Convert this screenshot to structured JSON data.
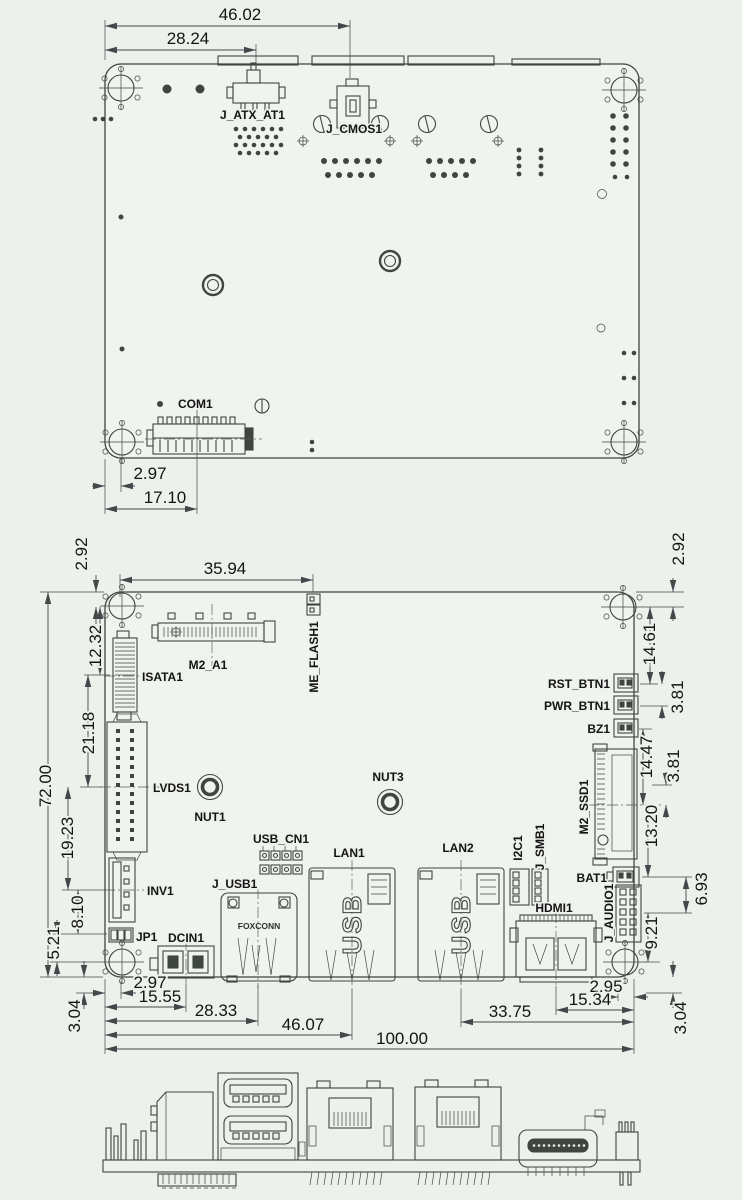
{
  "colors": {
    "background": "#edf1eb",
    "line": "#3f4540",
    "text": "#141414"
  },
  "top_view": {
    "labels": {
      "j_atx_at1": "J_ATX_AT1",
      "j_cmos1": "J_CMOS1",
      "com1": "COM1"
    },
    "dims": {
      "width_46": "46.02",
      "width_28": "28.24",
      "offset_2_97": "2.97",
      "offset_17_10": "17.10"
    }
  },
  "main_view": {
    "labels": {
      "isata1": "ISATA1",
      "m2_a1": "M2_A1",
      "me_flash1": "ME_FLASH1",
      "lvds1": "LVDS1",
      "nut1": "NUT1",
      "nut3": "NUT3",
      "inv1": "INV1",
      "jp1": "JP1",
      "dcin1": "DCIN1",
      "j_usb1": "J_USB1",
      "usb_cn1": "USB_CN1",
      "lan1": "LAN1",
      "lan2": "LAN2",
      "i2c1": "I2C1",
      "j_smb1": "J_SMB1",
      "hdmi1": "HDMI1",
      "rst_btn1": "RST_BTN1",
      "pwr_btn1": "PWR_BTN1",
      "bz1": "BZ1",
      "m2_ssd1": "M2_SSD1",
      "bat1": "BAT1",
      "j_audio1": "J_AUDIO1",
      "foxconn": "FOXCONN",
      "lan1_marking": "USB",
      "lan2_marking": "USB"
    },
    "dims": {
      "top_35_94": "35.94",
      "left_2_92": "2.92",
      "left_12_32": "12.32",
      "left_21_18": "21.18",
      "left_72_00": "72.00",
      "left_19_23": "19.23",
      "left_8_10": "8.10",
      "left_5_21": "5.21",
      "left_3_04": "3.04",
      "bot_2_97": "2.97",
      "bot_15_55": "15.55",
      "bot_28_33": "28.33",
      "bot_46_07": "46.07",
      "bot_100_00": "100.00",
      "bot_33_75": "33.75",
      "bot_15_34": "15.34",
      "bot_2_95": "2.95",
      "right_2_92": "2.92",
      "right_14_61": "14.61",
      "right_3_81_a": "3.81",
      "right_14_47": "14.47",
      "right_3_81_b": "3.81",
      "right_13_20": "13.20",
      "right_6_93": "6.93",
      "right_9_21": "9.21",
      "right_3_04": "3.04"
    }
  }
}
